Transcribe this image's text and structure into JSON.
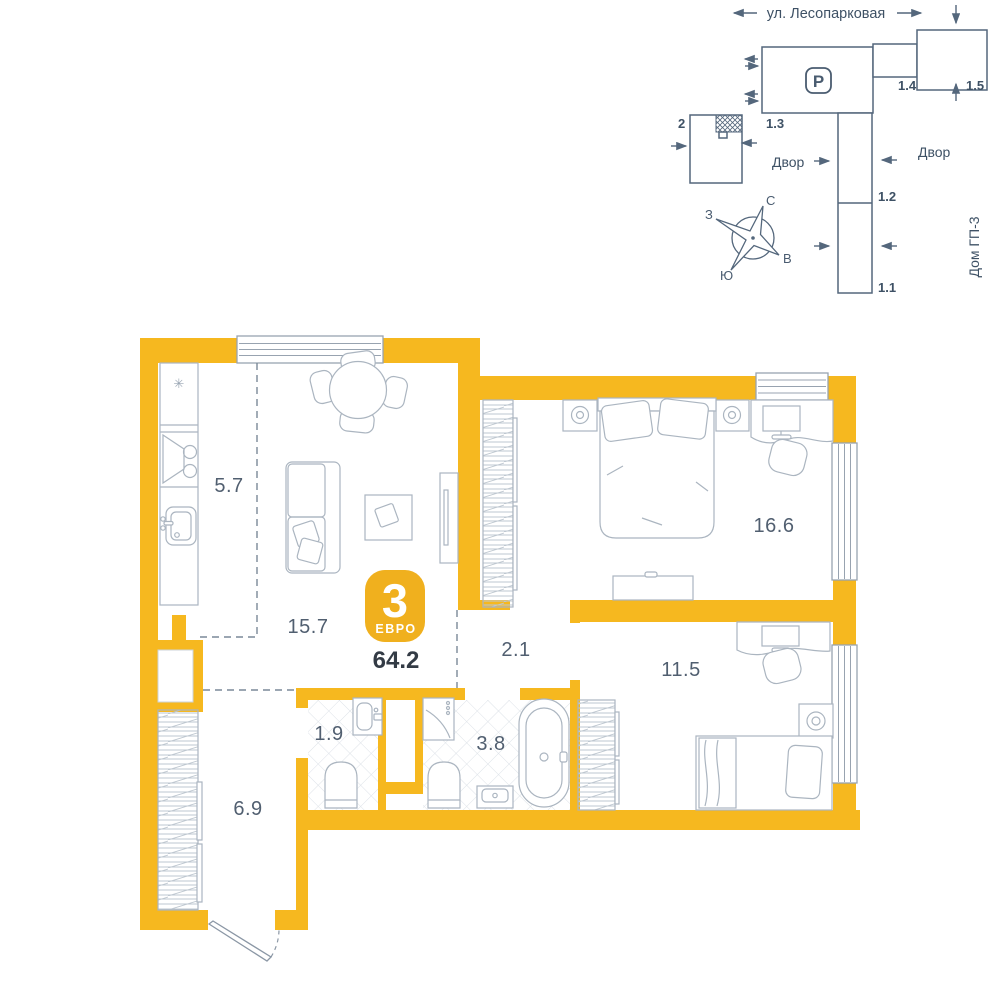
{
  "colors": {
    "wall_yellow": "#f6b81f",
    "badge_yellow": "#f0b01e",
    "furniture_line": "#abb5c0",
    "site_line": "#54677c",
    "label_text": "#515f70",
    "dark_text": "#333b45"
  },
  "site": {
    "street": "ул. Лесопарковая",
    "parking": "P",
    "labels": {
      "b2": "2",
      "b13": "1.3",
      "b14": "1.4",
      "b15": "1.5",
      "b12": "1.2",
      "b11": "1.1"
    },
    "yard_left": "Двор",
    "yard_right": "Двор",
    "house": "Дом ГП-3",
    "compass": {
      "n": "С",
      "s": "Ю",
      "w": "З",
      "e": "В"
    }
  },
  "plan": {
    "badge": {
      "rooms": "3",
      "type": "ЕВРО"
    },
    "total_area": "64.2",
    "areas": {
      "kitchen": "5.7",
      "living": "15.7",
      "bedroom": "16.6",
      "corridor": "2.1",
      "bedroom2": "11.5",
      "wc": "1.9",
      "bathroom": "3.8",
      "entry": "6.9"
    },
    "icons": {
      "fridge_snowflake": "✳"
    }
  }
}
